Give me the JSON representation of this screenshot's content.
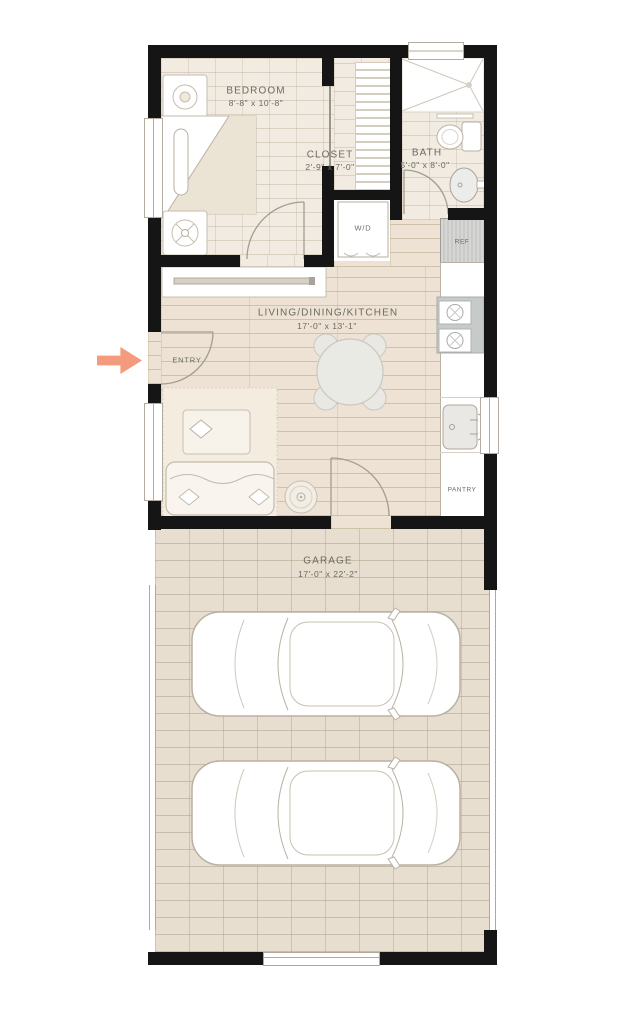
{
  "colors": {
    "wall": "#151515",
    "arrow": "#f49a7d",
    "tile_floor": "#f2ebe1",
    "wood_floor": "#ede2d3",
    "garage_floor": "#e8decf",
    "label_text": "#6b6a62"
  },
  "rooms": [
    {
      "id": "bedroom",
      "name": "BEDROOM",
      "dims": "8'-8\" x 10'-8\""
    },
    {
      "id": "closet",
      "name": "CLOSET",
      "dims": "2'-9\" x 7'-0\""
    },
    {
      "id": "bath",
      "name": "BATH",
      "dims": "5'-0\" x 8'-0\""
    },
    {
      "id": "living",
      "name": "LIVING/DINING/KITCHEN",
      "dims": "17'-0\" x 13'-1\""
    },
    {
      "id": "garage",
      "name": "GARAGE",
      "dims": "17'-0\" x 22'-2\""
    }
  ],
  "labels": {
    "entry": "ENTRY",
    "washer_dryer": "W/D",
    "refrigerator": "REF",
    "pantry": "PANTRY"
  }
}
